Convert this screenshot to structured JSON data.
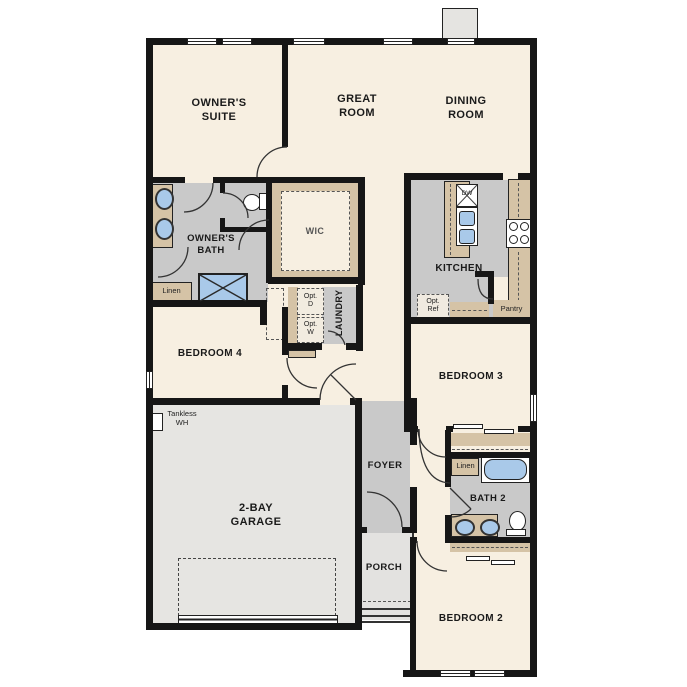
{
  "colors": {
    "page_bg": "#ffffff",
    "wall": "#161616",
    "cream": "#f7efe1",
    "floor_gray": "#c9c9c9",
    "garage_gray": "#e6e5e2",
    "porch_gray": "#e3e2e0",
    "tan": "#d5c3a6",
    "blue": "#a9c9e9",
    "chimney": "#e5e4e1",
    "line": "#2a2a2a"
  },
  "labels": {
    "owners_suite": "OWNER'S\nSUITE",
    "great_room": "GREAT\nROOM",
    "dining_room": "DINING\nROOM",
    "owners_bath": "OWNER'S\nBATH",
    "wic": "WIC",
    "kitchen": "KITCHEN",
    "laundry": "LAUNDRY",
    "bedroom4": "BEDROOM 4",
    "bedroom3": "BEDROOM 3",
    "bedroom2": "BEDROOM 2",
    "garage": "2-BAY\nGARAGE",
    "foyer": "FOYER",
    "porch": "PORCH",
    "bath2": "BATH 2",
    "linen_owners": "Linen",
    "linen_hall": "Linen",
    "pantry": "Pantry",
    "opt_ref": "Opt.\nRef",
    "opt_d": "Opt.\nD",
    "opt_w": "Opt.\nW",
    "dw": "DW",
    "tankless_wh": "Tankless\nWH"
  }
}
